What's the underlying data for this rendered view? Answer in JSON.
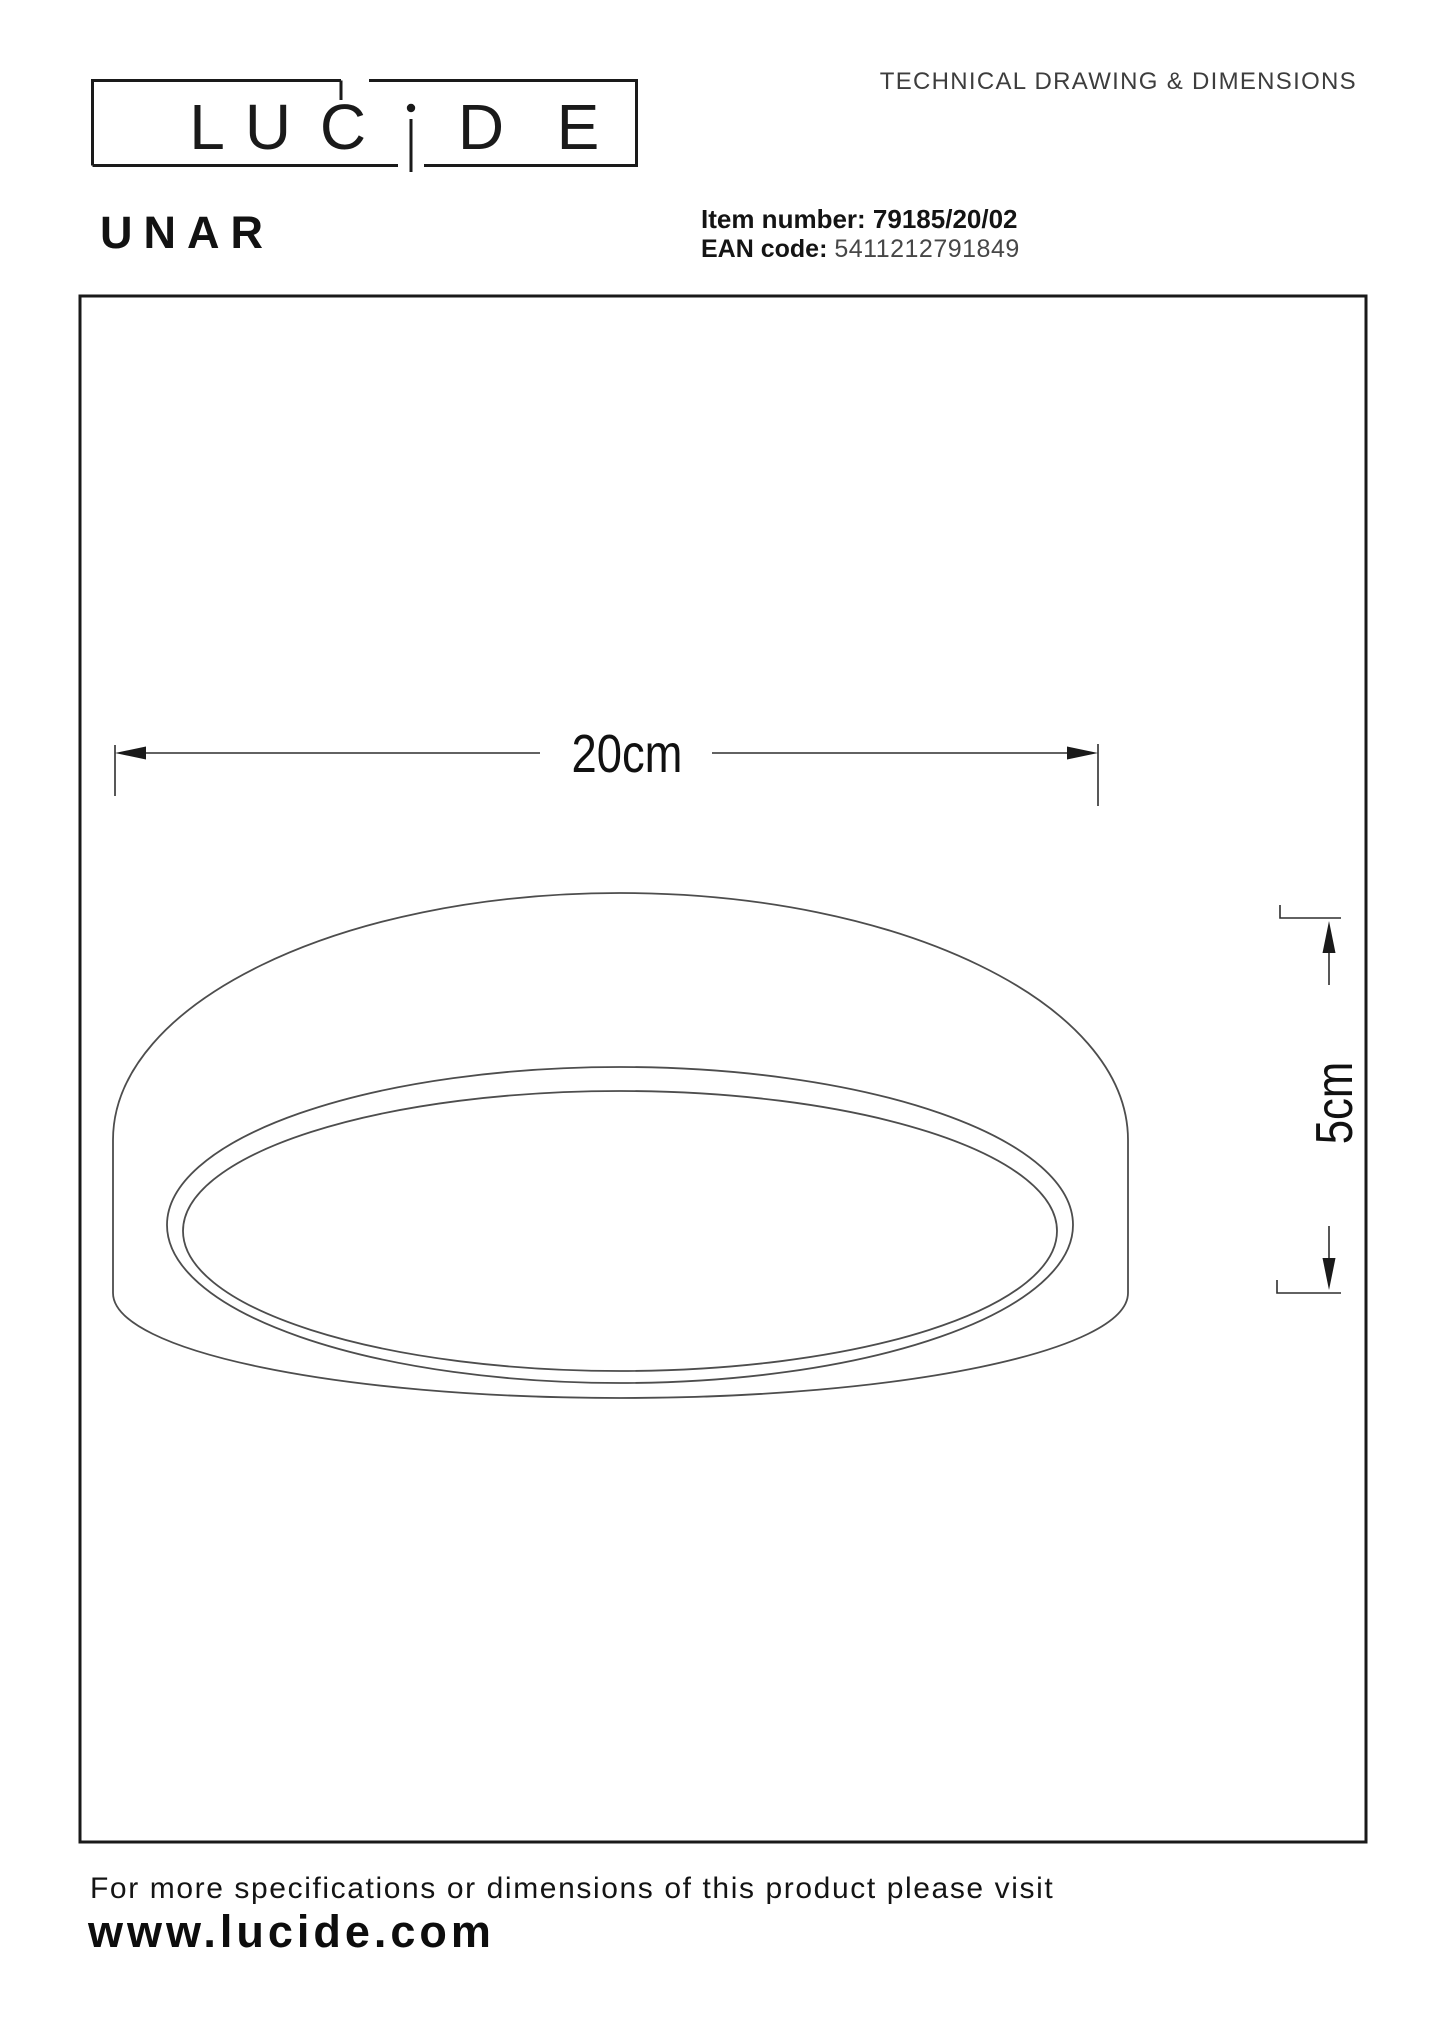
{
  "header": {
    "technical_label": "TECHNICAL DRAWING & DIMENSIONS"
  },
  "brand": {
    "name": "LUCIDE",
    "logo_letters": [
      "L",
      "U",
      "C",
      "D",
      "E"
    ]
  },
  "product": {
    "name": "UNAR",
    "item_label": "Item number:",
    "item_value": "79185/20/02",
    "ean_label": "EAN code:",
    "ean_value": "5411212791849"
  },
  "drawing": {
    "diameter_label": "20cm",
    "height_label": "5cm"
  },
  "footer": {
    "note": "For more specifications or dimensions of this product please visit",
    "website": "www.lucide.com"
  },
  "colors": {
    "ink": "#1a1a1a",
    "line": "#4d4d4d",
    "dimension": "#2e2e2e",
    "muted": "#474747",
    "background": "#ffffff"
  }
}
